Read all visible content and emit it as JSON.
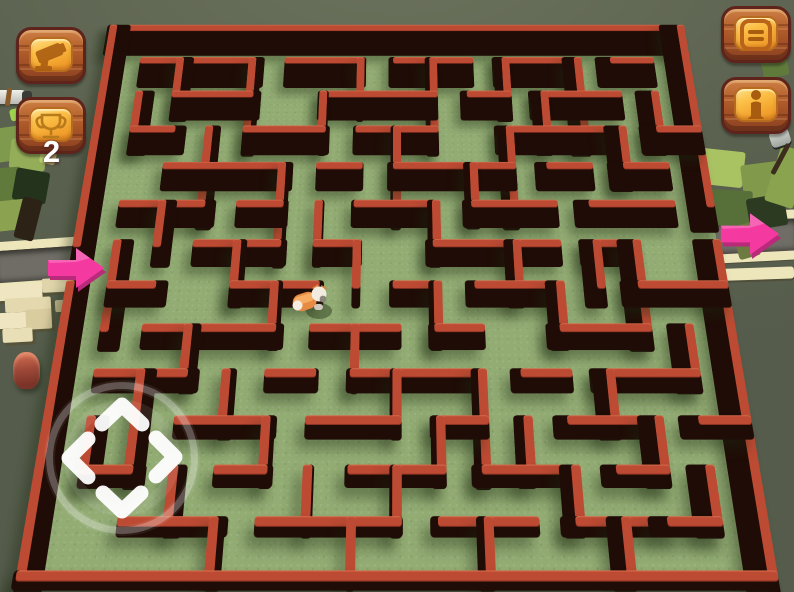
{
  "app": {
    "name": "voxel-maze-game"
  },
  "hud": {
    "camera_button": {
      "icon": "security-camera-icon"
    },
    "trophy_button": {
      "icon": "trophy-icon",
      "count": "2"
    },
    "menu_button": {
      "icon": "menu-icon"
    },
    "info_button": {
      "icon": "info-icon"
    }
  },
  "joystick": {
    "directions": [
      "up",
      "left",
      "right",
      "down"
    ]
  },
  "arrows": {
    "entrance_direction": "right",
    "exit_direction": "right"
  },
  "character": {
    "type": "dog",
    "body_color": "#e78b44",
    "head_color": "#f2ece0"
  },
  "colors": {
    "background": "#5a614f",
    "maze_floor": "#93ac74",
    "wall_top": "#bd4a33",
    "wall_side": "#1f0c06",
    "road": "#6f6d66",
    "road_edge": "#eee6bb",
    "arrow_pink": "#f43aa1",
    "arrow_pink_dark": "#b92a7a",
    "button_wood": "#a85425",
    "button_panel": "#f7b033",
    "joystick_white": "#ffffff"
  },
  "maze": {
    "cols": 16,
    "rows": 13,
    "cell_w": 47,
    "cell_h": 50,
    "wall_thickness": 10,
    "boundary_h_walls": [
      [
        0,
        0,
        16
      ],
      [
        0,
        13,
        16
      ]
    ],
    "boundary_v_walls": [
      [
        0,
        0,
        6
      ],
      [
        0,
        7,
        6
      ],
      [
        16,
        0,
        5
      ],
      [
        16,
        6,
        7
      ]
    ],
    "h_walls": [
      [
        1,
        1,
        3
      ],
      [
        5,
        1,
        2
      ],
      [
        8,
        1,
        2
      ],
      [
        11,
        1,
        2
      ],
      [
        14,
        1,
        1
      ],
      [
        2,
        2,
        2
      ],
      [
        6,
        2,
        3
      ],
      [
        10,
        2,
        1
      ],
      [
        12,
        2,
        2
      ],
      [
        1,
        3,
        1
      ],
      [
        4,
        3,
        2
      ],
      [
        7,
        3,
        2
      ],
      [
        11,
        3,
        3
      ],
      [
        15,
        3,
        1
      ],
      [
        2,
        4,
        3
      ],
      [
        6,
        4,
        1
      ],
      [
        8,
        4,
        3
      ],
      [
        12,
        4,
        1
      ],
      [
        14,
        4,
        1
      ],
      [
        1,
        5,
        2
      ],
      [
        4,
        5,
        1
      ],
      [
        7,
        5,
        2
      ],
      [
        10,
        5,
        2
      ],
      [
        13,
        5,
        2
      ],
      [
        3,
        6,
        2
      ],
      [
        6,
        6,
        1
      ],
      [
        9,
        6,
        3
      ],
      [
        13,
        6,
        1
      ],
      [
        1,
        7,
        1
      ],
      [
        4,
        7,
        2
      ],
      [
        8,
        7,
        1
      ],
      [
        10,
        7,
        2
      ],
      [
        14,
        7,
        2
      ],
      [
        2,
        8,
        3
      ],
      [
        6,
        8,
        2
      ],
      [
        9,
        8,
        1
      ],
      [
        12,
        8,
        2
      ],
      [
        1,
        9,
        2
      ],
      [
        5,
        9,
        1
      ],
      [
        7,
        9,
        3
      ],
      [
        11,
        9,
        1
      ],
      [
        13,
        9,
        2
      ],
      [
        3,
        10,
        2
      ],
      [
        6,
        10,
        2
      ],
      [
        9,
        10,
        1
      ],
      [
        12,
        10,
        2
      ],
      [
        15,
        10,
        1
      ],
      [
        1,
        11,
        1
      ],
      [
        4,
        11,
        1
      ],
      [
        7,
        11,
        2
      ],
      [
        10,
        11,
        2
      ],
      [
        13,
        11,
        1
      ],
      [
        2,
        12,
        2
      ],
      [
        5,
        12,
        3
      ],
      [
        9,
        12,
        2
      ],
      [
        12,
        12,
        2
      ],
      [
        14,
        12,
        1
      ]
    ],
    "v_walls": [
      [
        1,
        2,
        1
      ],
      [
        1,
        6,
        2
      ],
      [
        1,
        10,
        1
      ],
      [
        2,
        1,
        1
      ],
      [
        2,
        5,
        1
      ],
      [
        2,
        9,
        2
      ],
      [
        3,
        3,
        2
      ],
      [
        3,
        8,
        1
      ],
      [
        3,
        11,
        1
      ],
      [
        4,
        1,
        2
      ],
      [
        4,
        6,
        1
      ],
      [
        4,
        9,
        1
      ],
      [
        4,
        12,
        1
      ],
      [
        5,
        4,
        2
      ],
      [
        5,
        7,
        1
      ],
      [
        5,
        10,
        1
      ],
      [
        6,
        2,
        1
      ],
      [
        6,
        5,
        1
      ],
      [
        6,
        11,
        1
      ],
      [
        7,
        1,
        1
      ],
      [
        7,
        6,
        1
      ],
      [
        7,
        8,
        1
      ],
      [
        7,
        12,
        1
      ],
      [
        8,
        3,
        2
      ],
      [
        8,
        9,
        1
      ],
      [
        8,
        11,
        1
      ],
      [
        9,
        1,
        2
      ],
      [
        9,
        5,
        1
      ],
      [
        9,
        7,
        1
      ],
      [
        9,
        10,
        1
      ],
      [
        10,
        4,
        1
      ],
      [
        10,
        9,
        2
      ],
      [
        10,
        12,
        1
      ],
      [
        11,
        1,
        1
      ],
      [
        11,
        3,
        2
      ],
      [
        11,
        6,
        1
      ],
      [
        11,
        10,
        1
      ],
      [
        12,
        2,
        1
      ],
      [
        12,
        7,
        1
      ],
      [
        12,
        11,
        1
      ],
      [
        13,
        1,
        2
      ],
      [
        13,
        6,
        1
      ],
      [
        13,
        9,
        1
      ],
      [
        13,
        12,
        1
      ],
      [
        14,
        3,
        1
      ],
      [
        14,
        6,
        2
      ],
      [
        14,
        10,
        1
      ],
      [
        15,
        2,
        1
      ],
      [
        15,
        8,
        1
      ],
      [
        15,
        11,
        1
      ]
    ]
  }
}
